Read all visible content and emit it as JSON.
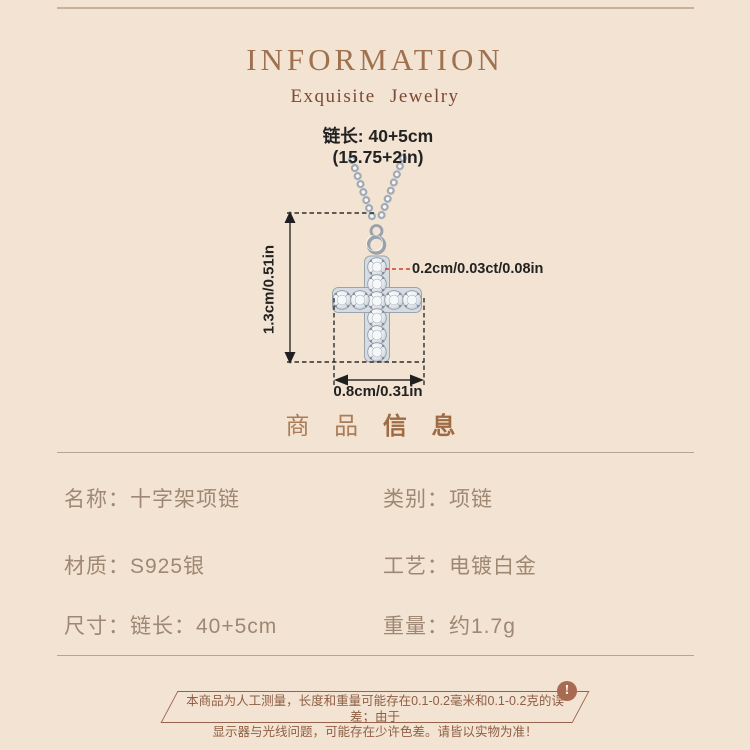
{
  "colors": {
    "background": "#f2e3d2",
    "title": "#a0714e",
    "subtitle": "#7b4a33",
    "section_heading": "#ab7c57",
    "spec_text": "#9f8873",
    "divider": "#b5a494",
    "dimension_text": "#222222",
    "red_pointer": "#d0402c",
    "disclaimer_text": "#8f5f45",
    "badge_background": "#a96a52",
    "silver_metal": "#9aa4ae"
  },
  "header": {
    "title": "INFORMATION",
    "subtitle": "Exquisite  Jewelry"
  },
  "figure": {
    "chain_length_line1": "链长: 40+5cm",
    "chain_length_line2": "(15.75+2in)",
    "pendant_height": "1.3cm/0.51in",
    "stone_size": "0.2cm/0.03ct/0.08in",
    "pendant_width": "0.8cm/0.31in"
  },
  "section_heading": {
    "part1": "商 品",
    "part2": "信 息"
  },
  "specs": {
    "rows": [
      {
        "left": "名称：十字架项链",
        "right": "类别：项链"
      },
      {
        "left": "材质：S925银",
        "right": "工艺：电镀白金"
      },
      {
        "left": "尺寸：链长：40+5cm",
        "right": "重量：约1.7g"
      }
    ]
  },
  "disclaimer": {
    "badge": "!",
    "line1": "本商品为人工测量，长度和重量可能存在0.1-0.2毫米和0.1-0.2克的误差；由于",
    "line2": "显示器与光线问题，可能存在少许色差。请皆以实物为准！"
  }
}
